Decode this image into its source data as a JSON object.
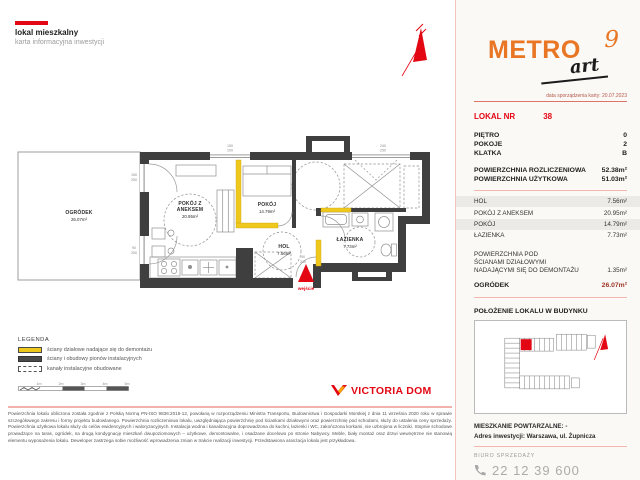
{
  "header": {
    "title": "lokal mieszkalny",
    "subtitle": "karta informacyjna inwestycji"
  },
  "plan": {
    "garden": {
      "name": "OGRÓDEK",
      "area": "26.07m²"
    },
    "rooms": [
      {
        "line1": "POKÓJ Z",
        "line2": "ANEKSEM",
        "area": "20.95m²"
      },
      {
        "line1": "POKÓJ",
        "area": "14.79m²"
      },
      {
        "line1": "HOL",
        "area": "7.56m²"
      },
      {
        "line1": "ŁAZIENKA",
        "area": "7.73m²"
      }
    ],
    "entrance_label": "wejście",
    "dims": [
      {
        "a": "150",
        "b": "250"
      },
      {
        "a": "90",
        "b": "250"
      },
      {
        "a": "150",
        "b": "100"
      },
      {
        "a": "240",
        "b": "250"
      },
      {
        "a": "90",
        "b": "210"
      }
    ]
  },
  "legend": {
    "title": "LEGENDA",
    "items": [
      {
        "icon": "yellow-wall-swatch",
        "label": "ściany działowe nadające się do demontażu"
      },
      {
        "icon": "dark-wall-swatch",
        "label": "ściany i obudowy pionów instalacyjnych"
      },
      {
        "icon": "dashed-duct-swatch",
        "label": "kanały instalacyjne obudowane"
      }
    ],
    "scale_ticks": [
      "1m",
      "2m",
      "3m",
      "4m",
      "5m"
    ]
  },
  "brand": {
    "name": "VICTORIA DOM"
  },
  "disclaimer": "Powierzchnia lokalu obliczona została zgodnie z Polską Normą PN-ISO 9836:2015-12, powołaną w rozporządzeniu Ministra Transportu, Budownictwa i Gospodarki Morskiej z dnia 11 września 2020 roku w sprawie szczegółowego zakresu i formy projektu budowlanego. Powierzchnia rozliczeniowa lokalu, uwzględniająca powierzchnię pod ściankami działowymi oraz powierzchnię pod schodami, służy do ustalenia ceny sprzedaży. Powierzchnia użytkowa lokalu służy do celów ewidencyjnych i waloryzacyjnych. Instalacja wodna i kanalizacyjna doprowadzona do kuchni, łazienki i WC, zakończona korkami, nie uzbrojona w liczniki. Stopnie schodowe prowadzące na taras, ogródek, na drugą kondygnację mieszkań dwupoziomowych – użytkowe, demontowalne, i osadzane docelowo po stronie Nabywcy. Meble, biały montaż oraz drzwi wewnętrzne nie stanowią elementu wyposażenia lokalu. Deweloper zastrzega sobie możliwość wprowadzenia zmian w trakcie realizacji inwestycji. Przedstawiona aranżacja lokalu jest przykładowa.",
  "panel": {
    "logo": {
      "metro": "METRO",
      "art": "art",
      "nine": "9"
    },
    "date_note": "data sporządzenia karty: 20.07.2023",
    "lokal": {
      "label": "LOKAL NR",
      "value": "38"
    },
    "info_rows": [
      {
        "label": "PIĘTRO",
        "value": "0"
      },
      {
        "label": "POKOJE",
        "value": "2"
      },
      {
        "label": "KLATKA",
        "value": "B"
      }
    ],
    "area_rows": [
      {
        "label": "POWIERZCHNIA ROZLICZENIOWA",
        "value": "52.38m²"
      },
      {
        "label": "POWIERZCHNIA UŻYTKOWA",
        "value": "51.03m²"
      }
    ],
    "room_rows": [
      {
        "label": "HOL",
        "value": "7.56m²"
      },
      {
        "label": "POKÓJ Z ANEKSEM",
        "value": "20.95m²"
      },
      {
        "label": "POKÓJ",
        "value": "14.79m²"
      },
      {
        "label": "ŁAZIENKA",
        "value": "7.73m²"
      }
    ],
    "demolition": {
      "line1": "POWIERZCHNIA POD",
      "line2": "ŚCIANAMI DZIAŁOWYMI",
      "line3": "NADAJĄCYMI SIĘ DO DEMONTAŻU",
      "value": "1.35m²"
    },
    "garden_row": {
      "label": "OGRÓDEK",
      "value": "26.07m²"
    },
    "position_title": "POŁOŻENIE LOKALU W BUDYNKU",
    "repeatable": "MIESZKANIE POWTARZALNE: -",
    "address": "Adres inwestycji: Warszawa, ul. Żupnicza",
    "office_label": "BIURO SPRZEDAŻY",
    "phone": "22 12 39 600"
  },
  "colors": {
    "accent_red": "#e30613",
    "metro_orange": "#e87624",
    "wall_dark": "#3f3f3f",
    "wall_yellow": "#eec81d",
    "panel_bg": "#fbf9f5"
  }
}
